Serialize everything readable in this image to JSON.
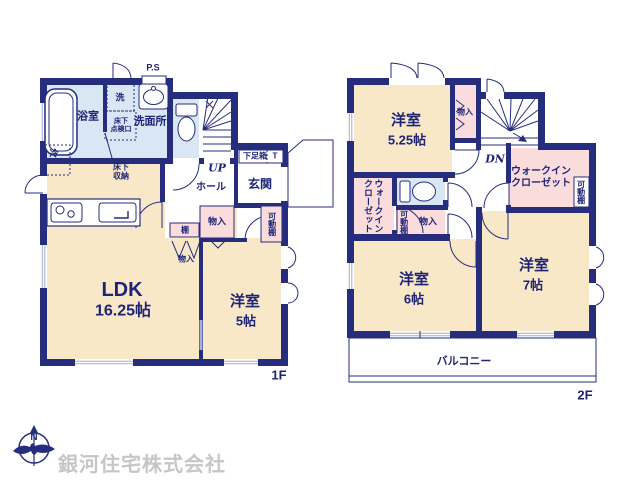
{
  "document": {
    "company_name": "銀河住宅株式会社",
    "compass_north_label": "N"
  },
  "colors": {
    "wall": "#262d7d",
    "room_floor": "#f8e8c7",
    "wet_area": "#d9e6f4",
    "closet": "#fadcdc",
    "company_text": "#c6c6c6"
  },
  "floor1": {
    "floor_label": "1F",
    "ps_label": "P.S",
    "bathroom": "浴室",
    "laundry": "洗",
    "washroom": "洗面所",
    "underfloor_access": "床下\n点検口",
    "fridge": "冷",
    "underfloor_storage": "床下\n収納",
    "stairs_up": "UP",
    "hall": "ホール",
    "entrance": "玄関",
    "shoe_box": "下足箱",
    "shoe_box_t": "T",
    "movable_shelf": "可動棚",
    "shelf": "棚",
    "closet_hall": "物入",
    "closet_under_stairs": "物入",
    "ldk_name": "LDK",
    "ldk_size": "16.25帖",
    "bedroom5_name": "洋室",
    "bedroom5_size": "5帖"
  },
  "floor2": {
    "floor_label": "2F",
    "bedroom525_name": "洋室",
    "bedroom525_size": "5.25帖",
    "closet_top": "物入",
    "stairs_down": "DN",
    "wic_right": "ウォークイン\nクローゼット",
    "movable_shelf_right": "可動棚",
    "wic_left": "ウォークイン\nクローゼット",
    "movable_shelf_mid": "可動棚",
    "closet_mid": "物入",
    "bedroom6_name": "洋室",
    "bedroom6_size": "6帖",
    "bedroom7_name": "洋室",
    "bedroom7_size": "7帖",
    "balcony": "バルコニー"
  }
}
